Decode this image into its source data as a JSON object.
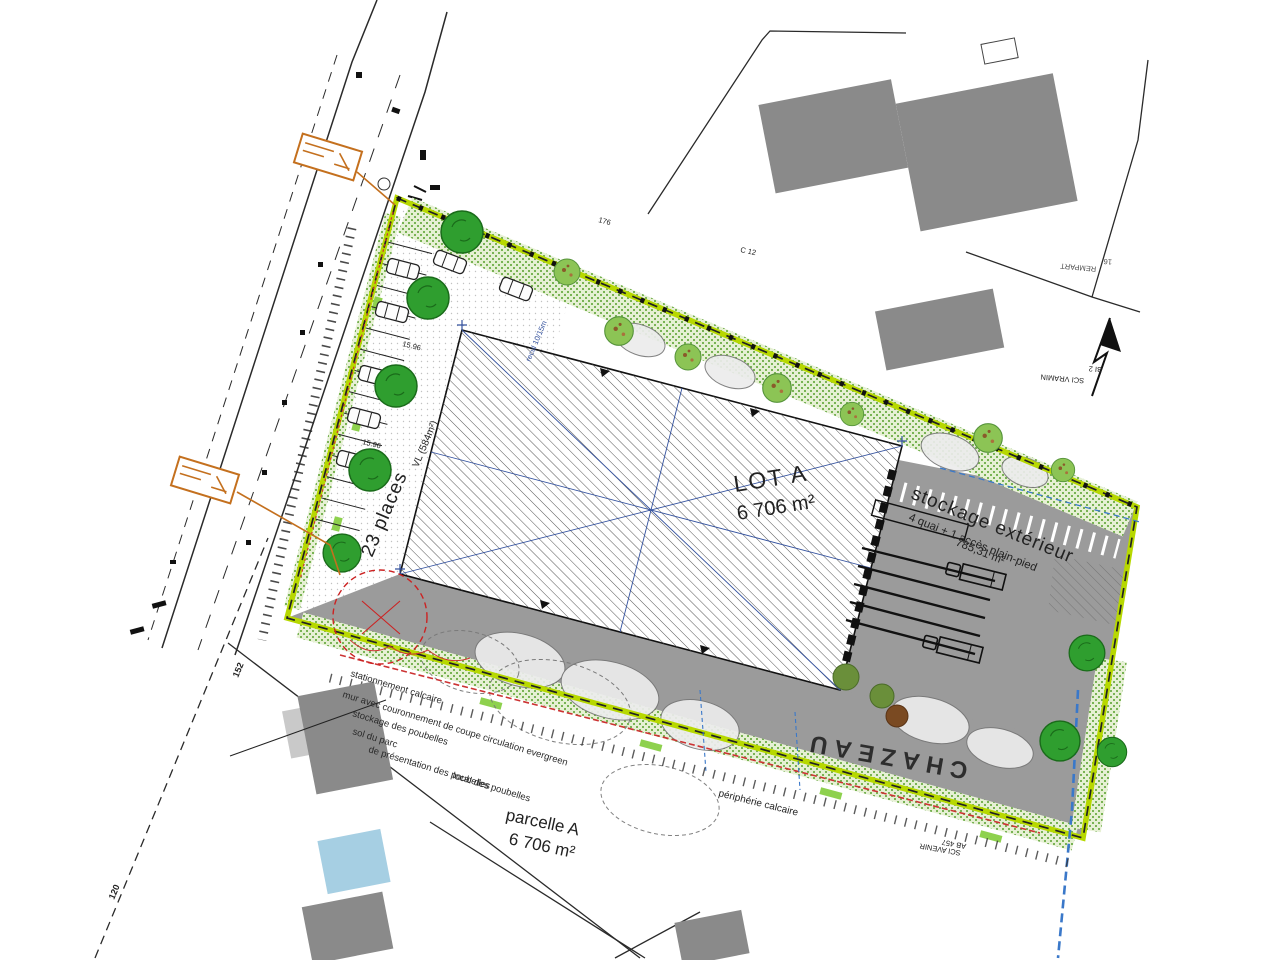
{
  "site": {
    "lot": {
      "name": "LOT A",
      "area": "6 706 m²"
    },
    "storage": {
      "title": "stockage extérieur",
      "subtitle": "4 quai + 1 accès plain-pied",
      "area": "785,31 m²"
    },
    "parking": {
      "places": "23 places",
      "type": "VL (584m²)",
      "dim1": "15.96",
      "dim2": "15.96",
      "setback": "recul 10/15m"
    },
    "parcel": {
      "name": "parcelle A",
      "area": "6 706 m²"
    },
    "street": {
      "name": "CHAZEAU",
      "periphery": "périphérie calcaire",
      "cadastre_ref": "AB 457",
      "owner": "SCI AVENIR"
    }
  },
  "neighbors": {
    "northeast": {
      "ref": "BI 2",
      "owner": "SCI VRAMIN"
    },
    "corner": {
      "number": "16",
      "name": "REMPART"
    },
    "cadastre_c": "C 12"
  },
  "dims": {
    "d176": "176",
    "d120": "120",
    "d152": "152"
  },
  "notes": {
    "line1": "stationnement calcaire",
    "line2": "mur avec couronnement de coupe circulation evergreen",
    "line3": "stockage des poubelles",
    "line4": "sol du parc",
    "line5": "de présentation des poubelles",
    "line6": "local des poubelles"
  },
  "colors": {
    "boundary_green": "#b7d800",
    "yard_gray": "#9b9b9b",
    "building_hatch": "#555555",
    "tree_dark": "#2f9e2f",
    "tree_light": "#8cc455",
    "utility_blue": "#3a78c9",
    "axis_blue": "#33519e",
    "note_orange": "#c4701e",
    "alert_red": "#cc2222",
    "neighbor_gray": "#8a8a8a",
    "pool_blue": "#a6cfe3"
  }
}
